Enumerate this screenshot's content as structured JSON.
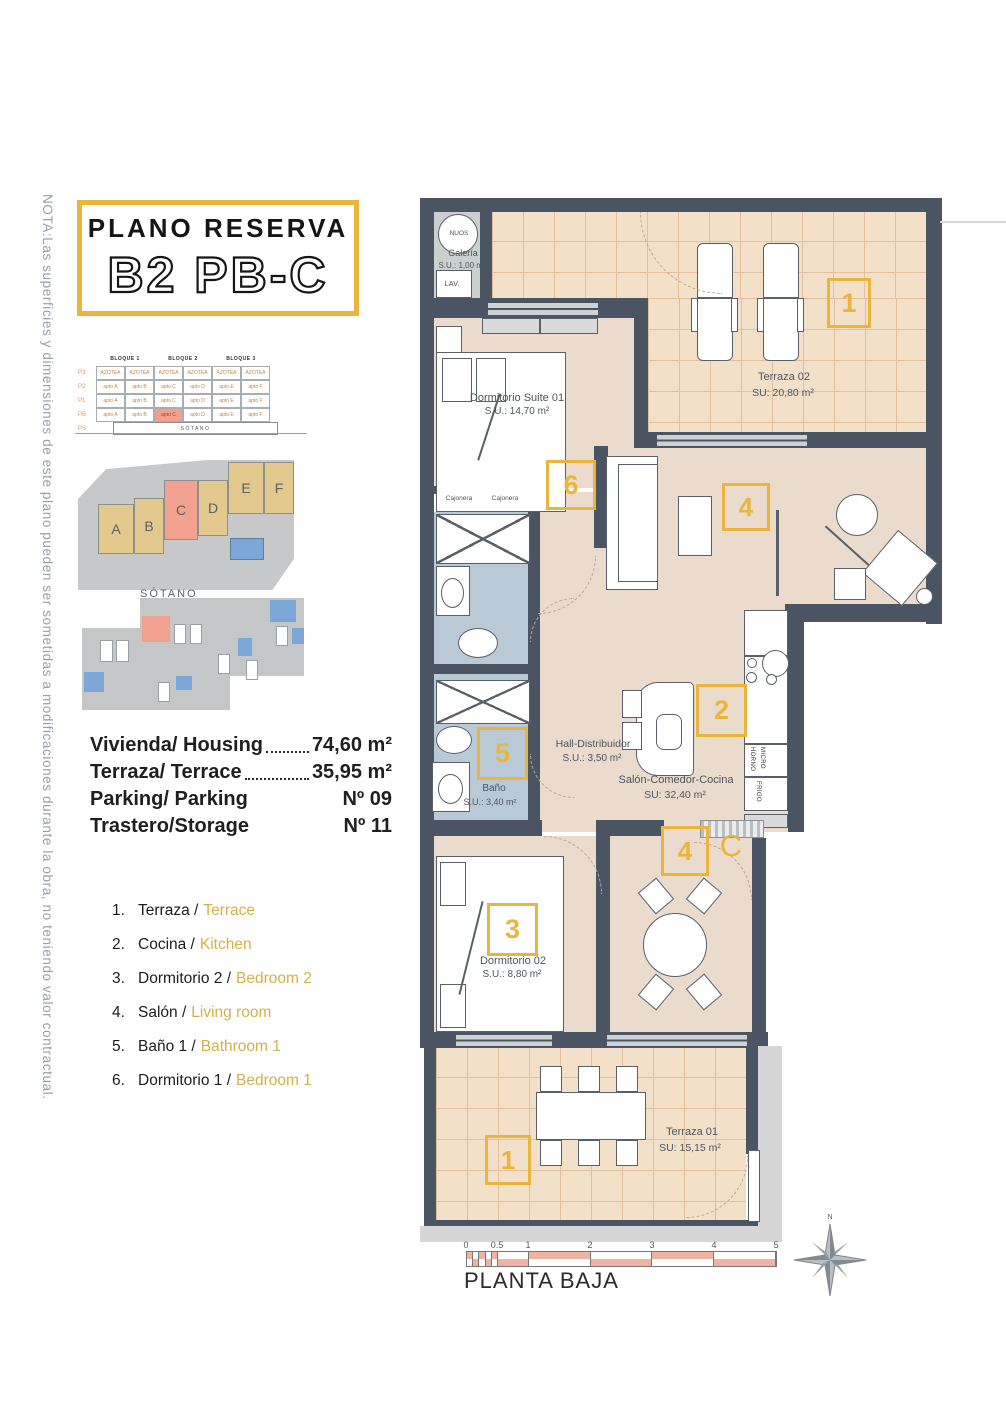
{
  "nota": "NOTA:Las superficies y dimensiones de este plano pueden ser sometidas a modificaciones durante la obra, no teniendo valor contractual.",
  "title": {
    "line1": "PLANO RESERVA",
    "line2": "B2 PB-C"
  },
  "colors": {
    "accent": "#E9B53C",
    "wall": "#4A5462",
    "floor": "#EADBCC",
    "terrace": "#F3E0C8",
    "bath": "#BAC9D6",
    "highlight": "#F2A08F"
  },
  "bloques": {
    "headers": [
      "BLOQUE 1",
      "BLOQUE 2",
      "BLOQUE 3"
    ],
    "rows": [
      {
        "label": "P3",
        "cells": [
          "AZOTEA",
          "AZOTEA",
          "AZOTEA",
          "AZOTEA",
          "AZOTEA",
          "AZOTEA"
        ],
        "highlight": -1
      },
      {
        "label": "P2",
        "cells": [
          "apto A",
          "apto B",
          "apto C",
          "apto D",
          "apto E",
          "apto F"
        ],
        "highlight": -1
      },
      {
        "label": "P1",
        "cells": [
          "apto A",
          "apto B",
          "apto C",
          "apto D",
          "apto E",
          "apto F"
        ],
        "highlight": -1
      },
      {
        "label": "PB",
        "cells": [
          "apto A",
          "apto B",
          "apto C",
          "apto D",
          "apto E",
          "apto F"
        ],
        "highlight": 2
      },
      {
        "label": "PS",
        "cells": [],
        "highlight": -1
      }
    ],
    "sotano": "SÓTANO"
  },
  "site_plan": {
    "blocks": [
      "A",
      "B",
      "C",
      "D",
      "E",
      "F"
    ],
    "highlight": "C"
  },
  "sotano_label": "SÓTANO",
  "details": [
    {
      "label": "Vivienda/ Housing",
      "dots": true,
      "value": "74,60 m²"
    },
    {
      "label": "Terraza/ Terrace",
      "dots": true,
      "value": "35,95 m²"
    },
    {
      "label": "Parking/ Parking",
      "dots": false,
      "value": "Nº 09"
    },
    {
      "label": "Trastero/Storage",
      "dots": false,
      "value": "Nº 11"
    }
  ],
  "legend": [
    {
      "num": "1.",
      "es": "Terraza /",
      "en": "Terrace"
    },
    {
      "num": "2.",
      "es": "Cocina /",
      "en": "Kitchen"
    },
    {
      "num": "3.",
      "es": "Dormitorio 2 /",
      "en": "Bedroom 2"
    },
    {
      "num": "4.",
      "es": "Salón /",
      "en": "Living room"
    },
    {
      "num": "5.",
      "es": "Baño 1 /",
      "en": "Bathroom 1"
    },
    {
      "num": "6.",
      "es": "Dormitorio 1 /",
      "en": "Bedroom 1"
    }
  ],
  "rooms": {
    "galeria": {
      "device": "NUOS",
      "name": "Galería",
      "area": "S.U.: 1,00 m²",
      "appliance": "LAV."
    },
    "suite": {
      "name": "Dormitorio Suite 01",
      "area": "S.U.: 14,70 m²",
      "marker": "6"
    },
    "terraza02": {
      "name": "Terraza 02",
      "area": "SU: 20,80 m²",
      "marker": "1"
    },
    "salon": {
      "name": "Salón-Comedor-Cocina",
      "area": "SU: 32,40 m²",
      "marker_living": "4",
      "marker_kitchen": "2",
      "marker_dining": "4",
      "door_letter": "C"
    },
    "hall": {
      "name": "Hall-Distribuidor",
      "area": "S.U.: 3,50 m²"
    },
    "bano": {
      "name": "Baño",
      "area": "S.U.: 3,40 m²",
      "marker": "5"
    },
    "cajonera1": "Cajonera",
    "cajonera2": "Cajonera",
    "kitchen": {
      "horno": "HORNO",
      "micro": "MICRO",
      "frigo": "FRIGO"
    },
    "dorm2": {
      "name": "Dormitorio 02",
      "area": "S.U.: 8,80 m²",
      "marker": "3"
    },
    "terraza01": {
      "name": "Terraza 01",
      "area": "SU: 15,15 m²",
      "marker": "1"
    }
  },
  "scale": {
    "ticks": [
      "0",
      "0.5",
      "1",
      "2",
      "3",
      "4",
      "5"
    ]
  },
  "plan_label": "PLANTA BAJA",
  "compass": "N"
}
